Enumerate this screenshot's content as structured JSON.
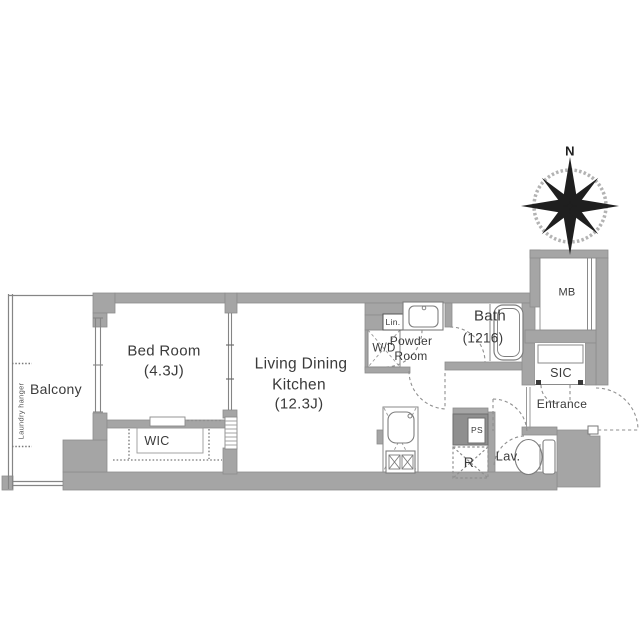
{
  "plan": {
    "type": "apartment-floor-plan",
    "colors": {
      "wall": "#a5a5a5",
      "wall_dark": "#8f8f8f",
      "line": "#858585",
      "dash": "#8f8f8f",
      "text": "#3a3a3a",
      "compass": "#1f1f1f"
    },
    "labels": {
      "balcony": "Balcony",
      "laundry_hanger": "Laundry hanger",
      "bedroom": "Bed Room",
      "bedroom_size": "(4.3J)",
      "ldk_line1": "Living Dining",
      "ldk_line2": "Kitchen",
      "ldk_size": "(12.3J)",
      "wic": "WIC",
      "wd": "W/D",
      "lin": "Lin.",
      "powder_line1": "Powder",
      "powder_line2": "Room",
      "bath": "Bath",
      "bath_size": "(1216)",
      "mb": "MB",
      "sic": "SIC",
      "entrance": "Entrance",
      "lav": "Lav.",
      "ps": "PS",
      "fridge": "R",
      "compass_north": "N"
    }
  }
}
